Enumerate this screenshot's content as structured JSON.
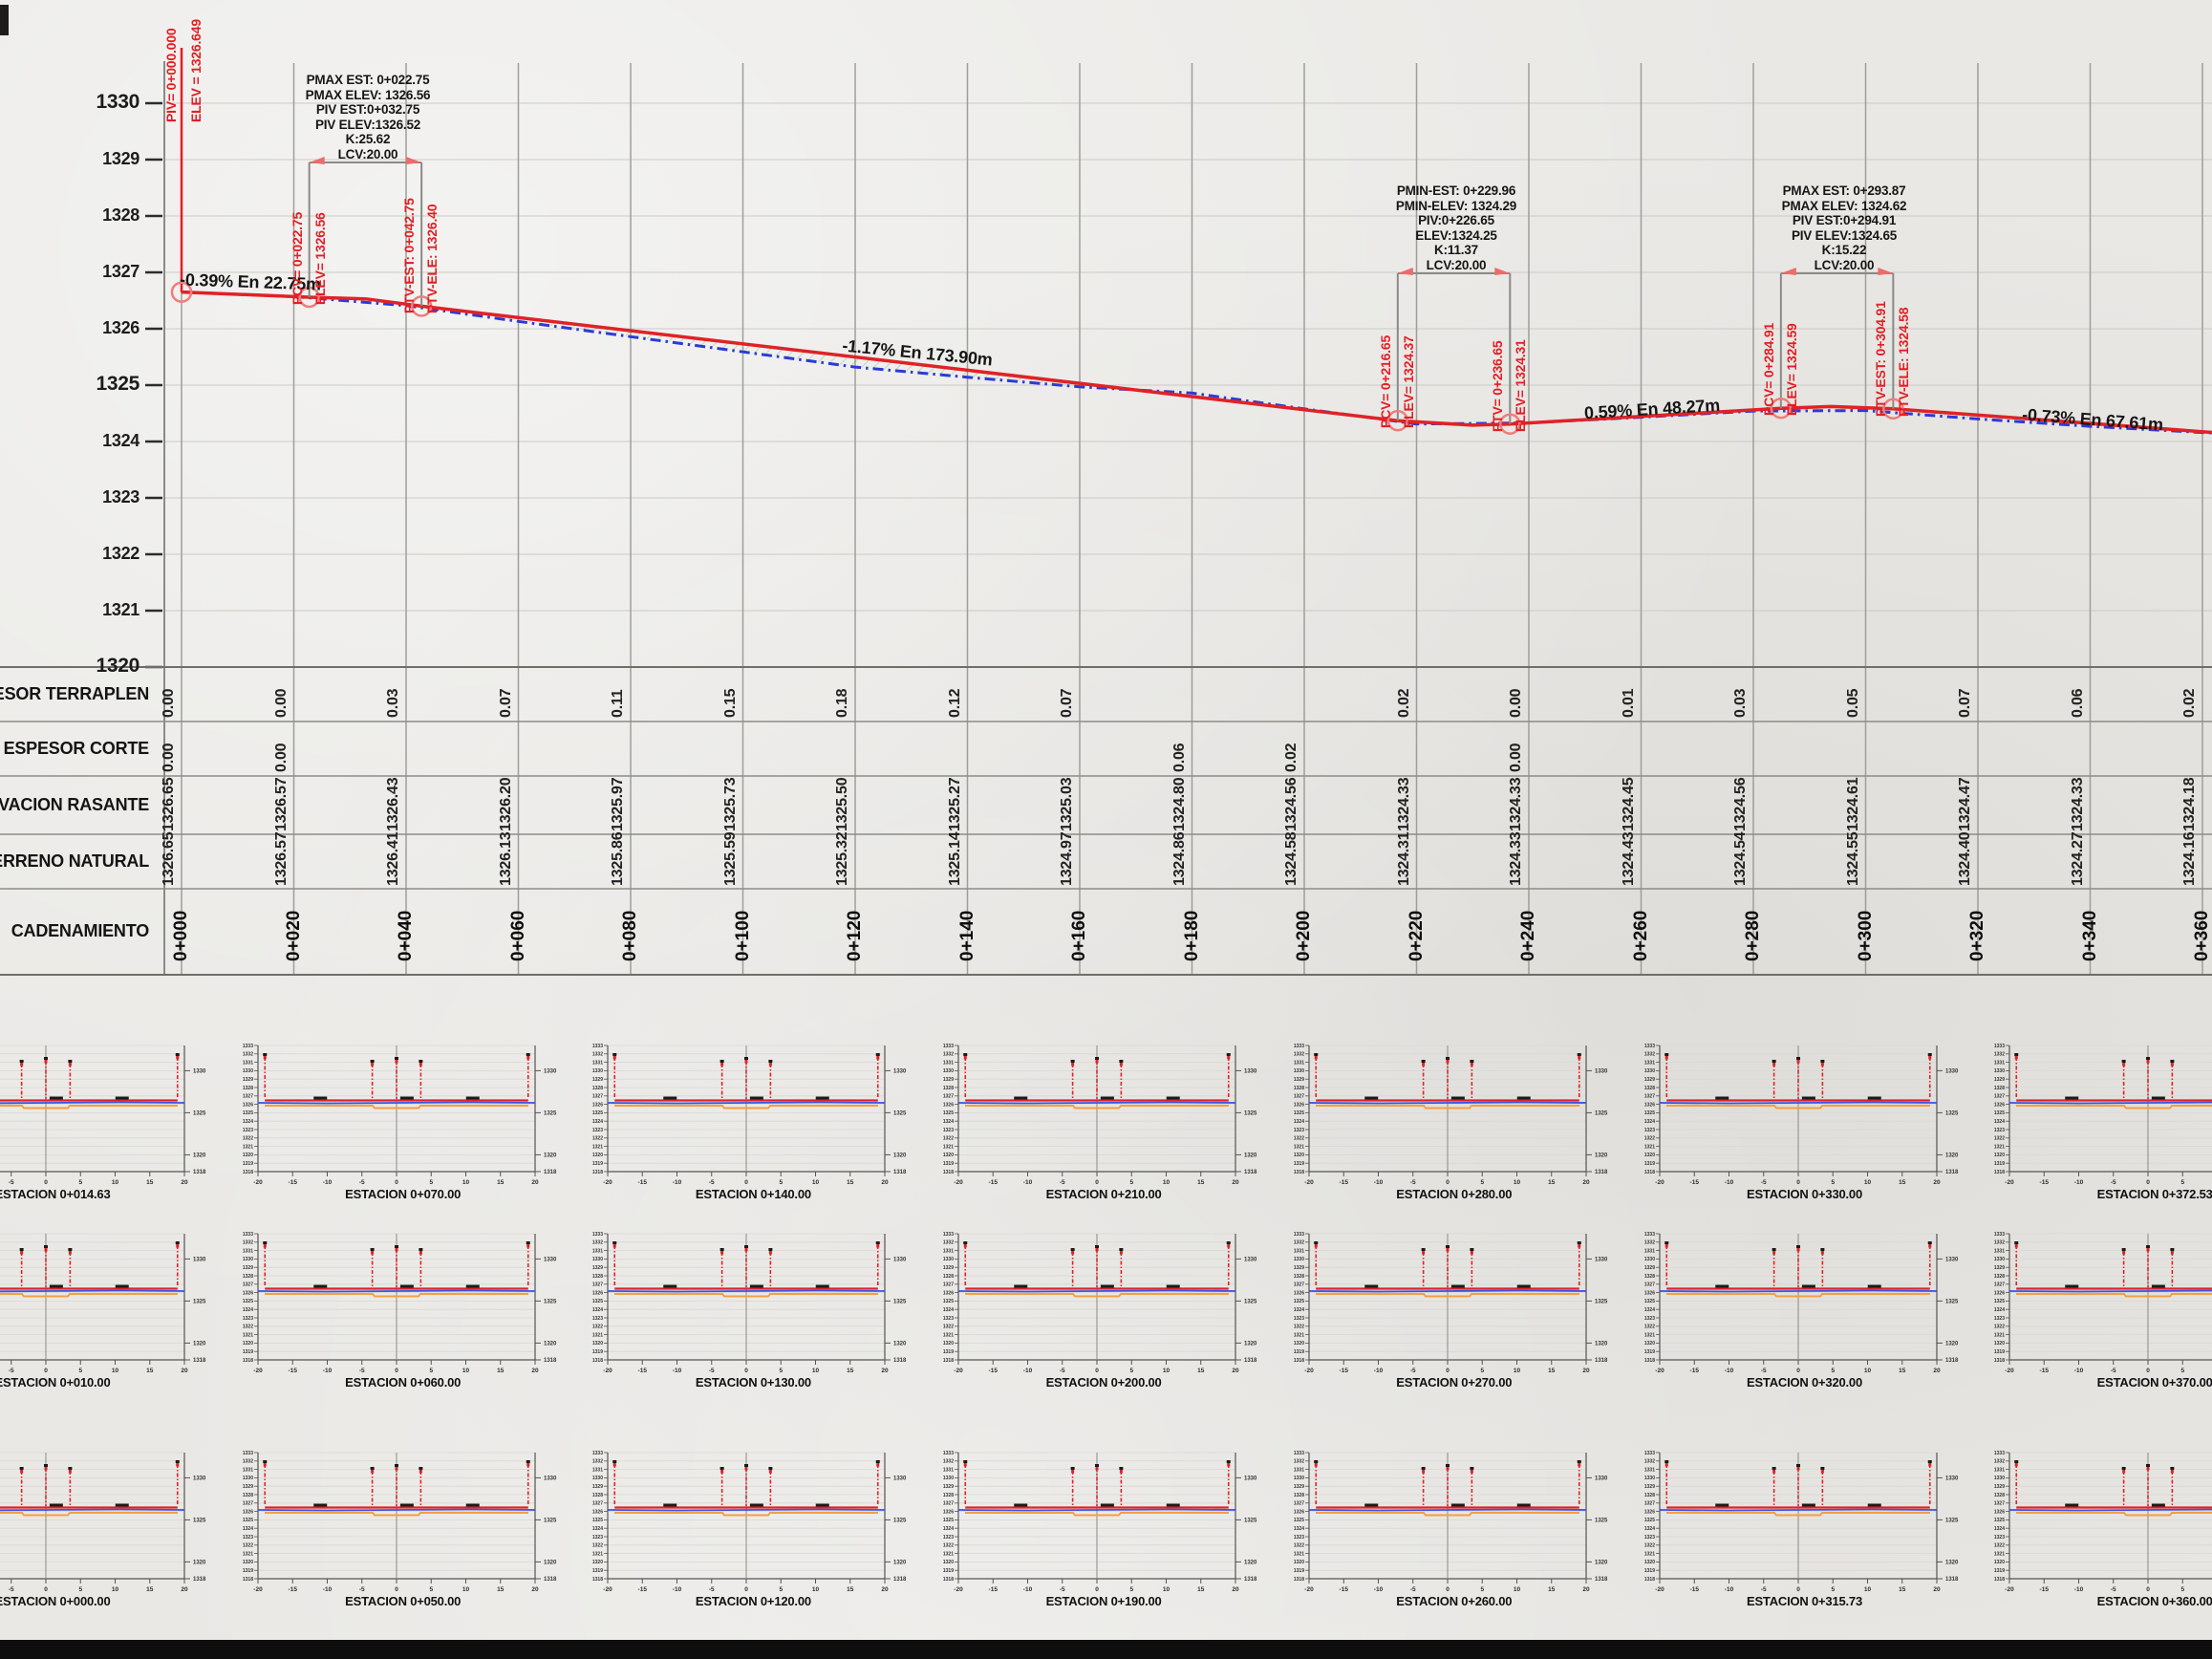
{
  "page": {
    "background": "#e9e8e5",
    "bottom_bar_color": "#0e0e0e"
  },
  "profile": {
    "y_ticks": [
      {
        "label": "1330",
        "bold": true
      },
      {
        "label": "1329",
        "bold": false
      },
      {
        "label": "1328",
        "bold": false
      },
      {
        "label": "1327",
        "bold": false
      },
      {
        "label": "1326",
        "bold": false
      },
      {
        "label": "1325",
        "bold": true
      },
      {
        "label": "1324",
        "bold": false
      },
      {
        "label": "1323",
        "bold": false
      },
      {
        "label": "1322",
        "bold": false
      },
      {
        "label": "1321",
        "bold": false
      },
      {
        "label": "1320",
        "bold": true
      }
    ],
    "start_labels": {
      "line1": "PIV= 0+000.000",
      "line2": "ELEV =  1326.649"
    },
    "slope_labels": [
      {
        "text": "-0.39% En 22.75m",
        "x": 262,
        "y": 296,
        "rot": 2
      },
      {
        "text": "-1.17% En 173.90m",
        "x": 960,
        "y": 370,
        "rot": 5.5
      },
      {
        "text": "0.59% En 48.27m",
        "x": 1729,
        "y": 429,
        "rot": -3.4
      },
      {
        "text": "-0.73% En 67.61m",
        "x": 2190,
        "y": 440,
        "rot": 4.2
      }
    ],
    "curves": [
      {
        "note_lines": [
          "PMAX EST: 0+022.75",
          "PMAX ELEV: 1326.56",
          "PIV EST:0+032.75",
          "PIV ELEV:1326.52",
          "K:25.62",
          "LCV:20.00"
        ],
        "note_cx": 385,
        "note_top": 76,
        "pcv": {
          "sta": 22.75,
          "elev": 1326.56,
          "labels": [
            "PCV= 0+022.75",
            "ELEV= 1326.56"
          ]
        },
        "ptv": {
          "sta": 42.75,
          "elev": 1326.4,
          "labels": [
            "PTV-EST: 0+042.75",
            "PTV-ELE: 1326.40"
          ]
        },
        "bracket_y": 170
      },
      {
        "note_lines": [
          "PMIN-EST: 0+229.96",
          "PMIN-ELEV: 1324.29",
          "PIV:0+226.65",
          "ELEV:1324.25",
          "K:11.37",
          "LCV:20.00"
        ],
        "note_cx": 1524,
        "note_top": 192,
        "pcv": {
          "sta": 216.65,
          "elev": 1324.37,
          "labels": [
            "PCV= 0+216.65",
            "ELEV= 1324.37"
          ]
        },
        "ptv": {
          "sta": 236.65,
          "elev": 1324.31,
          "labels": [
            "PTV= 0+236.65",
            "ELEV= 1324.31"
          ]
        },
        "bracket_y": 286
      },
      {
        "note_lines": [
          "PMAX EST: 0+293.87",
          "PMAX ELEV: 1324.62",
          "PIV EST:0+294.91",
          "PIV ELEV:1324.65",
          "K:15.22",
          "LCV:20.00"
        ],
        "note_cx": 1930,
        "note_top": 192,
        "pcv": {
          "sta": 284.91,
          "elev": 1324.59,
          "labels": [
            "PCV= 0+284.91",
            "ELEV= 1324.59"
          ]
        },
        "ptv": {
          "sta": 304.91,
          "elev": 1324.58,
          "labels": [
            "PTV-EST: 0+304.91",
            "PTV-ELE: 1324.58"
          ]
        },
        "bracket_y": 286
      }
    ],
    "start_marker": {
      "sta": 0,
      "elev": 1326.649
    }
  },
  "table": {
    "row_labels": [
      "ESPESOR TERRAPLEN",
      "ESPESOR CORTE",
      "ELEVACION RASANTE",
      "TERRENO NATURAL"
    ],
    "cadenamiento_label": "CADENAMIENTO",
    "stations": [
      "0+000",
      "0+020",
      "0+040",
      "0+060",
      "0+080",
      "0+100",
      "0+120",
      "0+140",
      "0+160",
      "0+180",
      "0+200",
      "0+220",
      "0+240",
      "0+260",
      "0+280",
      "0+300",
      "0+320",
      "0+340",
      "0+360"
    ],
    "values": {
      "espesor_terraplen": [
        "0.00",
        "0.00",
        "0.03",
        "0.07",
        "0.11",
        "0.15",
        "0.18",
        "0.12",
        "0.07",
        "",
        "",
        "0.02",
        "0.00",
        "0.01",
        "0.03",
        "0.05",
        "0.07",
        "0.06",
        "0.02"
      ],
      "espesor_corte": [
        "0.00",
        "0.00",
        "",
        "",
        "",
        "",
        "",
        "",
        "",
        "0.06",
        "0.02",
        "",
        "0.00",
        "",
        "",
        "",
        "",
        "",
        ""
      ],
      "elevacion_rasante": [
        "1326.65",
        "1326.57",
        "1326.43",
        "1326.20",
        "1325.97",
        "1325.73",
        "1325.50",
        "1325.27",
        "1325.03",
        "1324.80",
        "1324.56",
        "1324.33",
        "1324.33",
        "1324.45",
        "1324.56",
        "1324.61",
        "1324.47",
        "1324.33",
        "1324.18"
      ],
      "terreno_natural": [
        "1326.65",
        "1326.57",
        "1326.41",
        "1326.13",
        "1325.86",
        "1325.59",
        "1325.32",
        "1325.14",
        "1324.97",
        "1324.86",
        "1324.58",
        "1324.31",
        "1324.33",
        "1324.43",
        "1324.54",
        "1324.55",
        "1324.40",
        "1324.27",
        "1324.16"
      ]
    }
  },
  "chart_data": {
    "type": "line",
    "title": "Perfil longitudinal",
    "xlabel": "CADENAMIENTO",
    "ylabel": "ELEVACION",
    "ylim": [
      1320,
      1330
    ],
    "x_stations": [
      0,
      20,
      40,
      60,
      80,
      100,
      120,
      140,
      160,
      180,
      200,
      220,
      240,
      260,
      280,
      300,
      320,
      340,
      360
    ],
    "series": [
      {
        "name": "ELEVACION RASANTE",
        "color": "#e02226",
        "points": [
          [
            0,
            1326.65
          ],
          [
            22.75,
            1326.56
          ],
          [
            32.75,
            1326.53
          ],
          [
            42.75,
            1326.4
          ],
          [
            216.65,
            1324.37
          ],
          [
            229.96,
            1324.29
          ],
          [
            236.65,
            1324.31
          ],
          [
            284.91,
            1324.59
          ],
          [
            293.87,
            1324.62
          ],
          [
            304.91,
            1324.58
          ],
          [
            362,
            1324.16
          ]
        ]
      },
      {
        "name": "TERRENO NATURAL",
        "color": "#2b3bd6",
        "points": [
          [
            0,
            1326.65
          ],
          [
            20,
            1326.57
          ],
          [
            40,
            1326.41
          ],
          [
            60,
            1326.13
          ],
          [
            80,
            1325.86
          ],
          [
            100,
            1325.59
          ],
          [
            120,
            1325.32
          ],
          [
            140,
            1325.14
          ],
          [
            160,
            1324.97
          ],
          [
            180,
            1324.86
          ],
          [
            200,
            1324.58
          ],
          [
            220,
            1324.31
          ],
          [
            240,
            1324.33
          ],
          [
            260,
            1324.43
          ],
          [
            280,
            1324.54
          ],
          [
            300,
            1324.55
          ],
          [
            320,
            1324.4
          ],
          [
            340,
            1324.27
          ],
          [
            360,
            1324.16
          ],
          [
            362,
            1324.15
          ]
        ]
      }
    ],
    "annotations": [
      "-0.39% En 22.75m",
      "-1.17% En 173.90m",
      "0.59% En 48.27m",
      "-0.73% En 67.61m"
    ]
  },
  "sections": {
    "x_ticks": [
      "-20",
      "-15",
      "-10",
      "-5",
      "0",
      "5",
      "10",
      "15",
      "20"
    ],
    "y_left_labels": [
      "1333",
      "1332",
      "1331",
      "1330",
      "1329",
      "1328",
      "1327",
      "1326",
      "1325",
      "1324",
      "1323",
      "1322",
      "1321",
      "1320",
      "1319",
      "1318"
    ],
    "y_right_labels": [
      "1330",
      "1325",
      "1320",
      "1318"
    ],
    "rows": [
      {
        "titles": [
          "ESTACION 0+014.63",
          "ESTACION 0+070.00",
          "ESTACION 0+140.00",
          "ESTACION 0+210.00",
          "ESTACION 0+280.00",
          "ESTACION 0+330.00",
          "ESTACION 0+372.53"
        ]
      },
      {
        "titles": [
          "ESTACION 0+010.00",
          "ESTACION 0+060.00",
          "ESTACION 0+130.00",
          "ESTACION 0+200.00",
          "ESTACION 0+270.00",
          "ESTACION 0+320.00",
          "ESTACION 0+370.00"
        ]
      },
      {
        "titles": [
          "ESTACION 0+000.00",
          "ESTACION 0+050.00",
          "ESTACION 0+120.00",
          "ESTACION 0+190.00",
          "ESTACION 0+260.00",
          "ESTACION 0+315.73",
          "ESTACION 0+360.00"
        ]
      }
    ]
  }
}
